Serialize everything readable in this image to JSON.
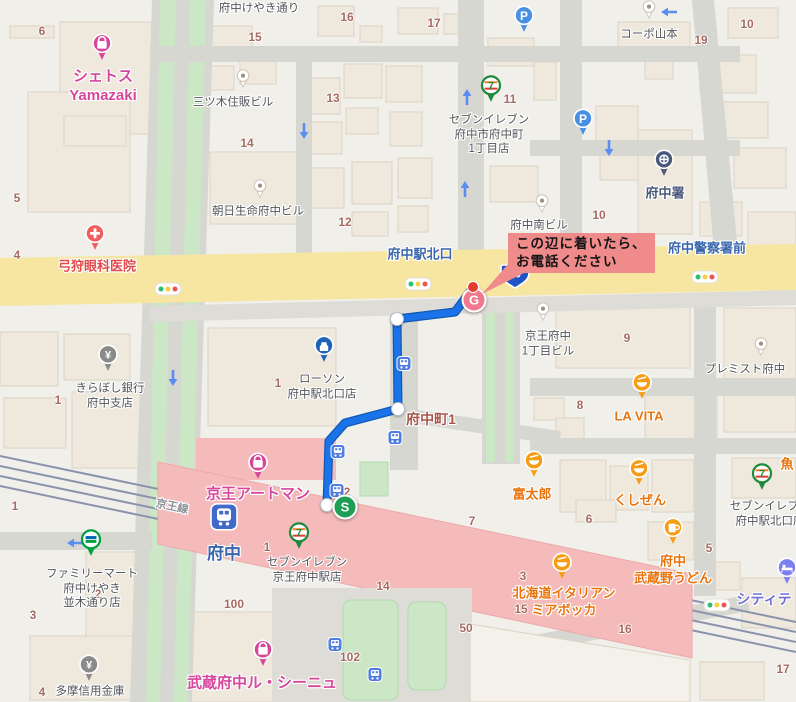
{
  "palette": {
    "pink": "#d6479c",
    "orange": "#e8740e",
    "blue": "#3a66ad",
    "red": "#e14b4b",
    "gray": "#52555b",
    "brown": "#a56a60",
    "purple": "#6f6fd4",
    "police": "#49597b",
    "rail": "#8b8f98",
    "route": "#1a73e8",
    "route_casing": "#1258b3",
    "band": "#f5baba",
    "road_yellow": "#f7e6a2",
    "callout_bg": "#f08b8b",
    "start_green": "#1f9e55",
    "goal_pink": "#f0798f",
    "dest_red": "#e23b30",
    "badge_blue": "#2053c5"
  },
  "callout": {
    "line1": "この辺に着いたら、",
    "line2": "お電話ください"
  },
  "route": {
    "points": "473,288 455,312 397,319 398,409 345,423 329,441 327,505",
    "waypoints": [
      {
        "x": 397,
        "y": 319
      },
      {
        "x": 398,
        "y": 409
      },
      {
        "x": 327,
        "y": 505
      }
    ],
    "start_label": "S",
    "start_x": 345,
    "start_y": 507,
    "goal_label": "G",
    "goal_x": 474,
    "goal_y": 300,
    "dest_x": 473,
    "dest_y": 287,
    "badge_text": "20",
    "badge_x": 515,
    "badge_y": 279
  },
  "labels": [
    {
      "t": "府中けやき通り",
      "x": 259,
      "y": 9,
      "c": "g"
    },
    {
      "t": "シェトス\nYamazaki",
      "x": 103,
      "y": 86,
      "c": "pk"
    },
    {
      "t": "三ツ木住販ビル",
      "x": 233,
      "y": 103,
      "c": "g"
    },
    {
      "t": "朝日生命府中ビル",
      "x": 258,
      "y": 212,
      "c": "g"
    },
    {
      "t": "コーポ山本",
      "x": 649,
      "y": 35,
      "c": "g"
    },
    {
      "t": "府中署",
      "x": 665,
      "y": 194,
      "c": "po"
    },
    {
      "t": "弓狩眼科医院",
      "x": 97,
      "y": 267,
      "c": "r"
    },
    {
      "t": "府中駅北口",
      "x": 420,
      "y": 255,
      "c": "b"
    },
    {
      "t": "府中警察署前",
      "x": 707,
      "y": 249,
      "c": "b"
    },
    {
      "t": "府中南ビル",
      "x": 539,
      "y": 226,
      "c": "g"
    },
    {
      "t": "セブンイレブン\n府中市府中町\n1丁目店",
      "x": 489,
      "y": 135,
      "c": "g"
    },
    {
      "t": "京王府中\n1丁目ビル",
      "x": 548,
      "y": 344,
      "c": "g"
    },
    {
      "t": "プレミスト府中",
      "x": 745,
      "y": 370,
      "c": "g"
    },
    {
      "t": "LA VITA",
      "x": 639,
      "y": 417,
      "c": "o"
    },
    {
      "t": "ローソン\n府中駅北口店",
      "x": 322,
      "y": 387,
      "c": "g"
    },
    {
      "t": "きらぼし銀行\n府中支店",
      "x": 110,
      "y": 396,
      "c": "g"
    },
    {
      "t": "府中町1",
      "x": 431,
      "y": 420,
      "c": "br"
    },
    {
      "t": "京王アートマン",
      "x": 258,
      "y": 494,
      "c": "pk"
    },
    {
      "t": "府中",
      "x": 224,
      "y": 554,
      "c": "st"
    },
    {
      "t": "セブンイレブン\n京王府中駅店",
      "x": 307,
      "y": 570,
      "c": "g"
    },
    {
      "t": "富太郎",
      "x": 532,
      "y": 495,
      "c": "o"
    },
    {
      "t": "くしぜん",
      "x": 640,
      "y": 501,
      "c": "o"
    },
    {
      "t": "セブンイレブン\n府中駅北口店",
      "x": 770,
      "y": 514,
      "c": "g"
    },
    {
      "t": "府中\n武蔵野うどん",
      "x": 673,
      "y": 570,
      "c": "o"
    },
    {
      "t": "シティテ",
      "x": 764,
      "y": 600,
      "c": "pu"
    },
    {
      "t": "魚",
      "x": 787,
      "y": 465,
      "c": "o"
    },
    {
      "t": "北海道イタリアン\nミアボッカ",
      "x": 564,
      "y": 602,
      "c": "o"
    },
    {
      "t": "ファミリーマート\n府中けやき\n並木通り店",
      "x": 92,
      "y": 589,
      "c": "g"
    },
    {
      "t": "多摩信用金庫",
      "x": 90,
      "y": 692,
      "c": "g"
    },
    {
      "t": "武蔵府中ル・シーニュ",
      "x": 262,
      "y": 683,
      "c": "pk"
    },
    {
      "t": "京王線",
      "x": 172,
      "y": 507,
      "c": "rl",
      "r": 12
    }
  ],
  "numbers": [
    {
      "t": "6",
      "x": 42,
      "y": 31
    },
    {
      "t": "15",
      "x": 255,
      "y": 37
    },
    {
      "t": "16",
      "x": 347,
      "y": 17
    },
    {
      "t": "17",
      "x": 434,
      "y": 23
    },
    {
      "t": "13",
      "x": 333,
      "y": 98
    },
    {
      "t": "14",
      "x": 247,
      "y": 143
    },
    {
      "t": "11",
      "x": 510,
      "y": 99
    },
    {
      "t": "12",
      "x": 345,
      "y": 222
    },
    {
      "t": "10",
      "x": 747,
      "y": 24
    },
    {
      "t": "19",
      "x": 701,
      "y": 40
    },
    {
      "t": "10",
      "x": 599,
      "y": 215
    },
    {
      "t": "5",
      "x": 17,
      "y": 198
    },
    {
      "t": "4",
      "x": 17,
      "y": 255
    },
    {
      "t": "9",
      "x": 627,
      "y": 338
    },
    {
      "t": "8",
      "x": 580,
      "y": 405
    },
    {
      "t": "1",
      "x": 58,
      "y": 400
    },
    {
      "t": "1",
      "x": 278,
      "y": 383
    },
    {
      "t": "2",
      "x": 347,
      "y": 492
    },
    {
      "t": "1",
      "x": 267,
      "y": 547
    },
    {
      "t": "7",
      "x": 472,
      "y": 521
    },
    {
      "t": "6",
      "x": 589,
      "y": 519
    },
    {
      "t": "1",
      "x": 15,
      "y": 506
    },
    {
      "t": "2",
      "x": 98,
      "y": 594
    },
    {
      "t": "3",
      "x": 33,
      "y": 615
    },
    {
      "t": "4",
      "x": 42,
      "y": 692
    },
    {
      "t": "100",
      "x": 234,
      "y": 604
    },
    {
      "t": "102",
      "x": 350,
      "y": 657
    },
    {
      "t": "14",
      "x": 383,
      "y": 586
    },
    {
      "t": "3",
      "x": 523,
      "y": 576
    },
    {
      "t": "15",
      "x": 521,
      "y": 609
    },
    {
      "t": "16",
      "x": 625,
      "y": 629
    },
    {
      "t": "50",
      "x": 466,
      "y": 628
    },
    {
      "t": "5",
      "x": 709,
      "y": 548
    },
    {
      "t": "17",
      "x": 783,
      "y": 669
    }
  ],
  "pins": [
    {
      "type": "shopping",
      "x": 102,
      "y": 51
    },
    {
      "type": "shopping",
      "x": 258,
      "y": 470
    },
    {
      "type": "shopping",
      "x": 263,
      "y": 657
    },
    {
      "type": "hospital",
      "x": 95,
      "y": 241
    },
    {
      "type": "bank",
      "x": 108,
      "y": 362
    },
    {
      "type": "bank",
      "x": 89,
      "y": 672
    },
    {
      "type": "seven",
      "x": 491,
      "y": 93
    },
    {
      "type": "seven",
      "x": 299,
      "y": 540
    },
    {
      "type": "seven",
      "x": 762,
      "y": 481
    },
    {
      "type": "lawson",
      "x": 324,
      "y": 353
    },
    {
      "type": "famima",
      "x": 91,
      "y": 547
    },
    {
      "type": "police",
      "x": 664,
      "y": 167
    },
    {
      "type": "food",
      "x": 534,
      "y": 468
    },
    {
      "type": "food",
      "x": 639,
      "y": 476
    },
    {
      "type": "food",
      "x": 642,
      "y": 390
    },
    {
      "type": "mug",
      "x": 673,
      "y": 535
    },
    {
      "type": "food",
      "x": 562,
      "y": 570
    },
    {
      "type": "hotel",
      "x": 787,
      "y": 575
    },
    {
      "type": "parking",
      "x": 524,
      "y": 23
    },
    {
      "type": "parking",
      "x": 583,
      "y": 126
    },
    {
      "type": "train",
      "x": 224,
      "y": 521
    },
    {
      "type": "bus",
      "x": 404,
      "y": 367
    },
    {
      "type": "bus",
      "x": 395,
      "y": 441
    },
    {
      "type": "bus",
      "x": 338,
      "y": 455
    },
    {
      "type": "bus",
      "x": 337,
      "y": 494
    },
    {
      "type": "bus",
      "x": 335,
      "y": 648
    },
    {
      "type": "bus",
      "x": 375,
      "y": 678
    },
    {
      "type": "dot",
      "x": 243,
      "y": 82
    },
    {
      "type": "dot",
      "x": 260,
      "y": 192
    },
    {
      "type": "dot",
      "x": 649,
      "y": 13
    },
    {
      "type": "dot",
      "x": 542,
      "y": 207
    },
    {
      "type": "dot",
      "x": 543,
      "y": 315
    },
    {
      "type": "dot",
      "x": 761,
      "y": 350
    }
  ],
  "traffic_lights": [
    {
      "x": 168,
      "y": 289
    },
    {
      "x": 418,
      "y": 284
    },
    {
      "x": 705,
      "y": 277
    },
    {
      "x": 717,
      "y": 605
    }
  ],
  "arrows": [
    {
      "x": 304,
      "y": 133,
      "dir": "down"
    },
    {
      "x": 467,
      "y": 95,
      "dir": "up"
    },
    {
      "x": 465,
      "y": 187,
      "dir": "up"
    },
    {
      "x": 667,
      "y": 12,
      "dir": "left"
    },
    {
      "x": 609,
      "y": 150,
      "dir": "down"
    },
    {
      "x": 173,
      "y": 380,
      "dir": "down"
    },
    {
      "x": 73,
      "y": 543,
      "dir": "left"
    }
  ]
}
